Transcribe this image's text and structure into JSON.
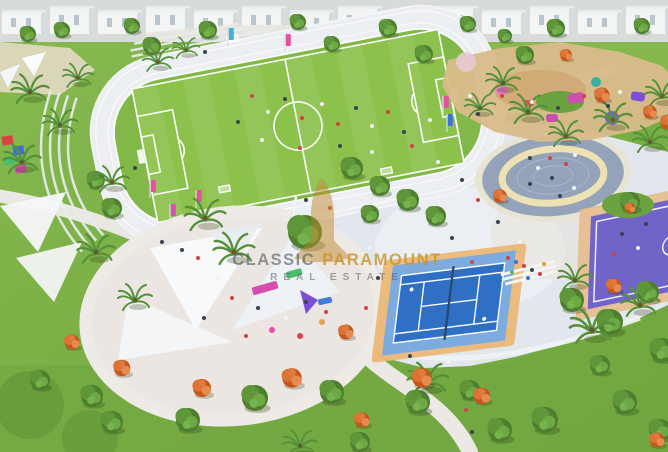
{
  "image": {
    "kind": "aerial-3d-render-photo",
    "subject": "Master-planned community park with sports and play amenities",
    "width_px": 668,
    "height_px": 452
  },
  "watermark": {
    "brand_word_1": "CLASSIC",
    "brand_word_2": "PARAMOUNT",
    "tagline": "REAL ESTATE",
    "logo": "gold-building-icon",
    "brand_color": "#c29233",
    "text_color": "#5e6569"
  },
  "scene_labels": {
    "running_track": "running track",
    "football_pitch": "football pitch",
    "tennis_court": "tennis court",
    "basketball_court": "basketball court",
    "splash_pad": "circular splash pad",
    "shaded_playground": "playground under white shade sails",
    "sand_playground": "sand adventure playground",
    "villas": "row of white villas",
    "amphitheater": "terraced seating steps"
  },
  "palette": {
    "grass": "#7db14a",
    "pitch_green": "#8cc14c",
    "track_surface": "#eceff2",
    "paving": "#e2e6ed",
    "sand": "#d9ba8a",
    "tennis_blue": "#2f6fc4",
    "tennis_apron": "#7cabe0",
    "court_border_tan": "#eab877",
    "basketball_purple": "#7164c8",
    "splash_pad_blue_gray": "#94a3ba",
    "splash_pad_ring": "#ede2b4",
    "shade_sail_white": "#f6f7f9",
    "play_magenta": "#d44fae",
    "play_purple": "#7d4fd8",
    "play_green": "#4cbd6b",
    "flower_orange": "#e0763a"
  }
}
